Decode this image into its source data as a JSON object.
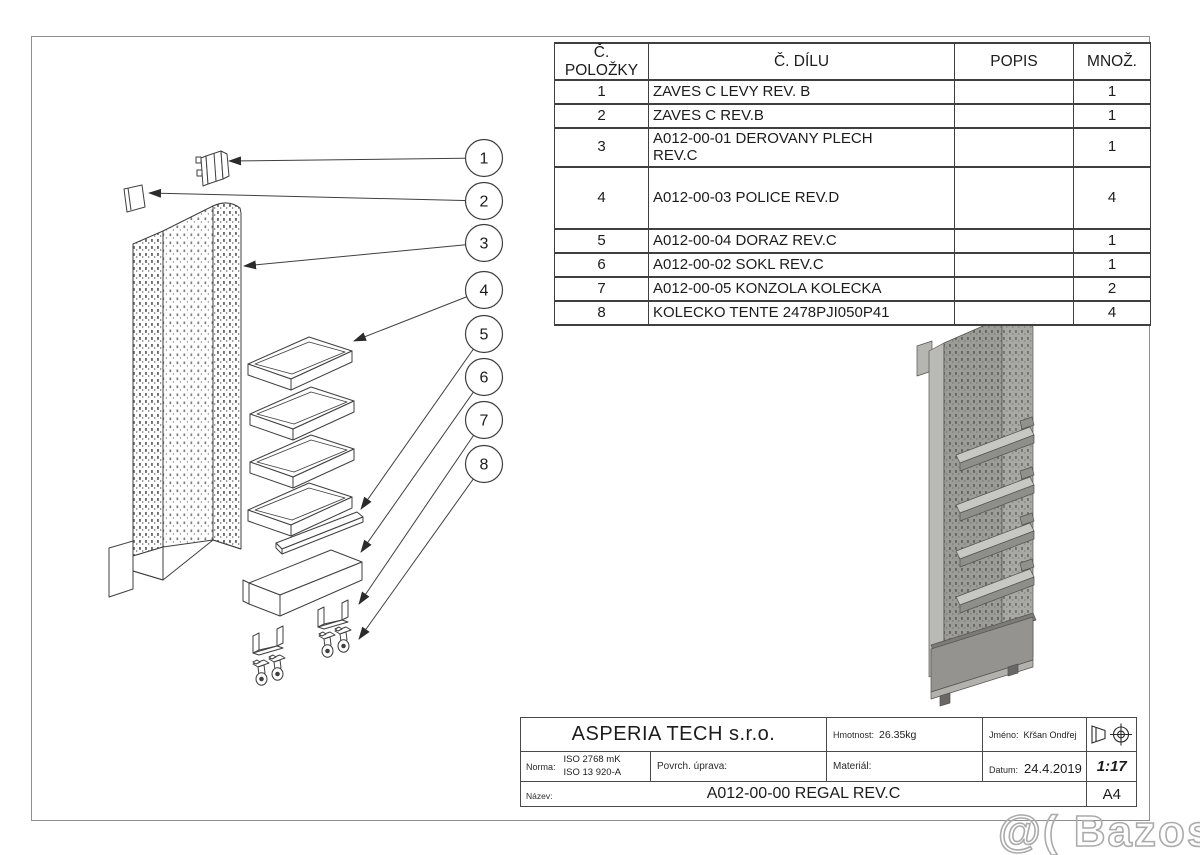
{
  "colors": {
    "line": "#3f3f3f",
    "frame": "#8f8f8f",
    "watermark": "#ababab",
    "shade_light": "#c7c7c3",
    "shade_mid": "#a3a3a0",
    "shade_dark": "#8e8e8b"
  },
  "bom_table": {
    "headers": [
      "Č. POLOŽKY",
      "Č. DÍLU",
      "POPIS",
      "MNOŽ."
    ],
    "rows": [
      {
        "item": "1",
        "part": "ZAVES C LEVY REV. B",
        "popis": "",
        "qty": "1"
      },
      {
        "item": "2",
        "part": "ZAVES C REV.B",
        "popis": "",
        "qty": "1"
      },
      {
        "item": "3",
        "part": "A012-00-01 DEROVANY PLECH\nREV.C",
        "popis": "",
        "qty": "1"
      },
      {
        "item": "4",
        "part": "A012-00-03 POLICE REV.D",
        "popis": "",
        "qty": "4"
      },
      {
        "item": "5",
        "part": "A012-00-04 DORAZ REV.C",
        "popis": "",
        "qty": "1"
      },
      {
        "item": "6",
        "part": "A012-00-02 SOKL REV.C",
        "popis": "",
        "qty": "1"
      },
      {
        "item": "7",
        "part": "A012-00-05 KONZOLA KOLECKA",
        "popis": "",
        "qty": "2"
      },
      {
        "item": "8",
        "part": "KOLECKO TENTE 2478PJI050P41",
        "popis": "",
        "qty": "4"
      }
    ]
  },
  "balloons": [
    "1",
    "2",
    "3",
    "4",
    "5",
    "6",
    "7",
    "8"
  ],
  "title_block": {
    "company": "ASPERIA TECH s.r.o.",
    "weight_label": "Hmotnost:",
    "weight_value": "26.35kg",
    "name_label": "Jméno:",
    "name_value": "Křšan Ondřej",
    "norma_label": "Norma:",
    "norma_value_1": "ISO 2768 mK",
    "norma_value_2": "ISO 13 920-A",
    "surface_label": "Povrch. úprava:",
    "material_label": "Materiál:",
    "date_label": "Datum:",
    "date_value": "24.4.2019",
    "scale": "1:17",
    "title_label": "Název:",
    "title_value": "A012-00-00 REGAL REV.C",
    "paper_size": "A4"
  },
  "watermark": {
    "text": "@( Bazos.cz"
  }
}
